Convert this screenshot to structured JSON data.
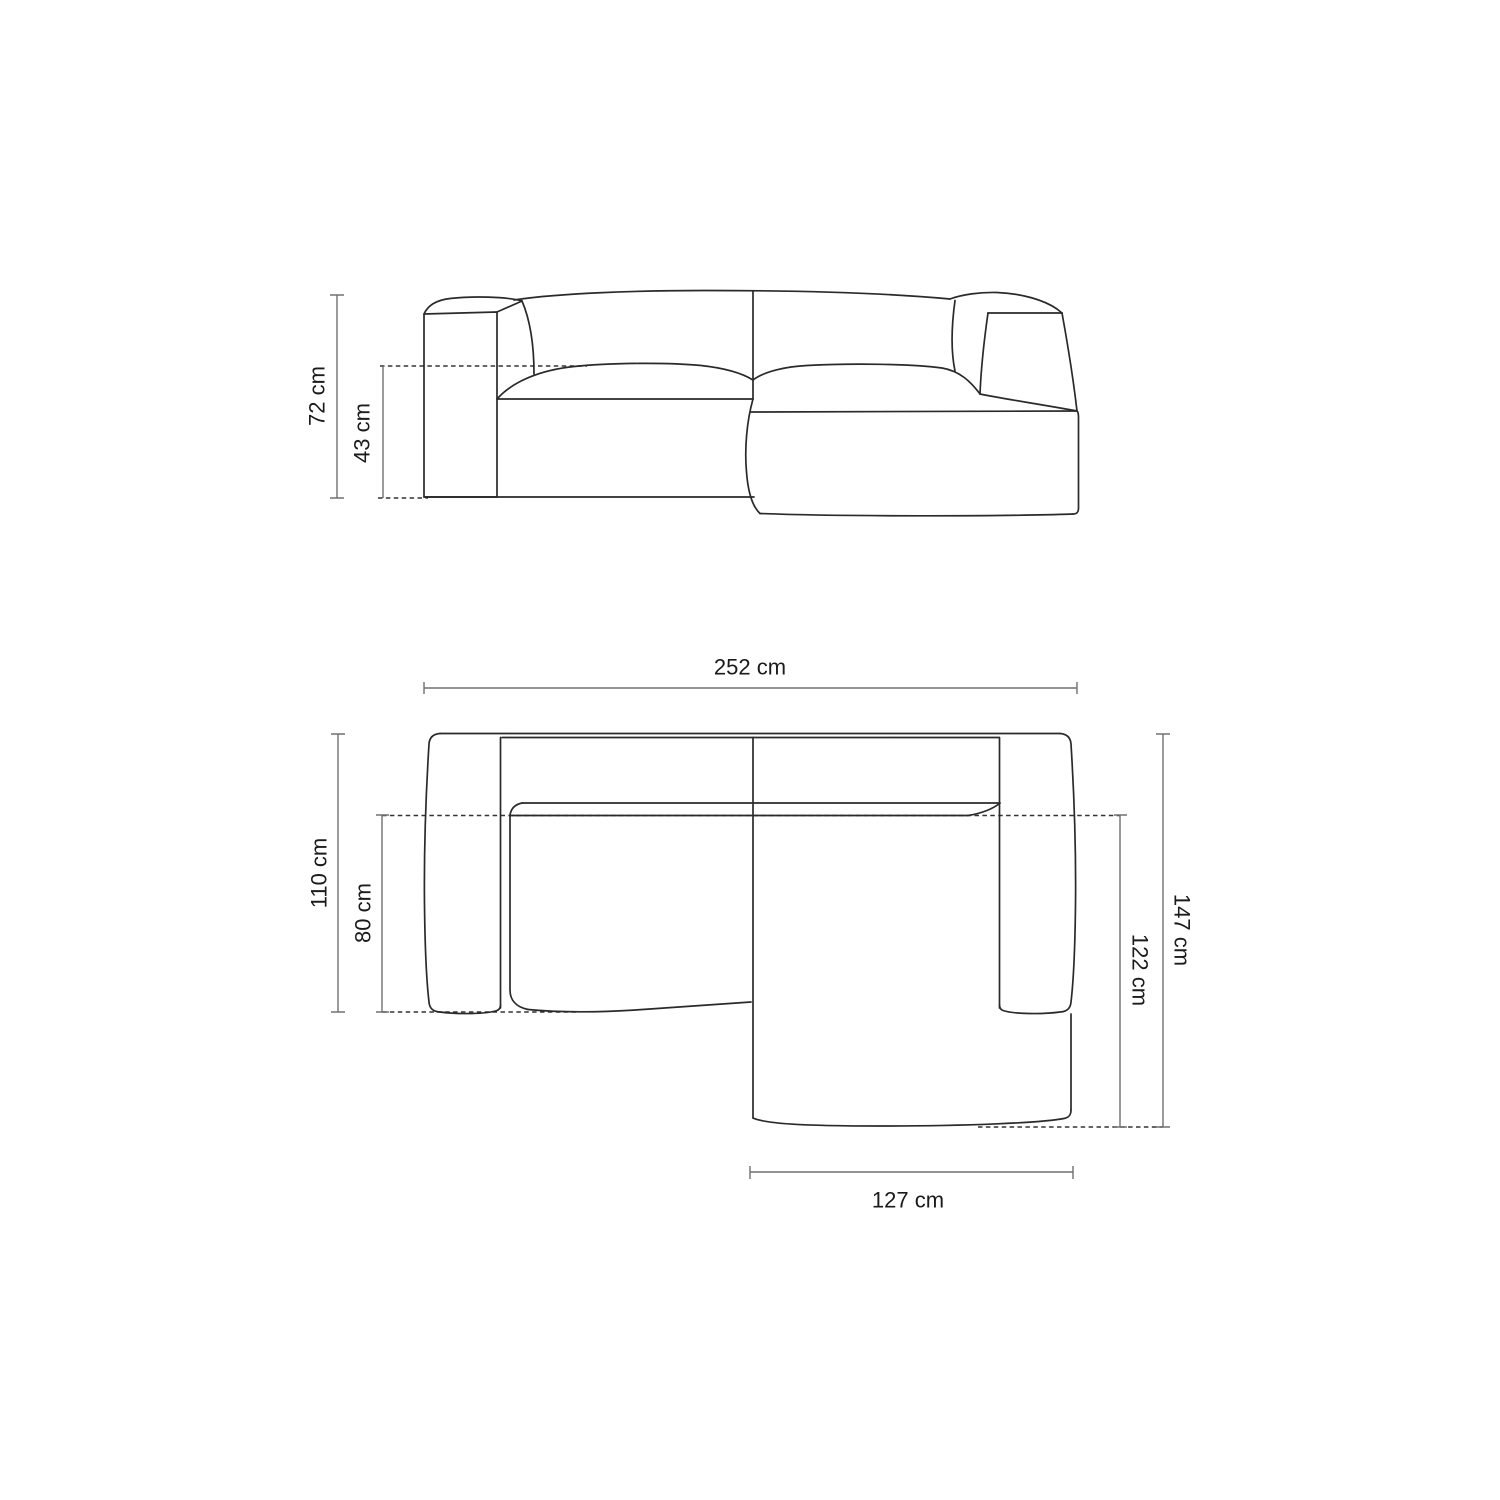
{
  "diagram": {
    "subject": "corner-sofa-with-chaise-dimension-drawing",
    "background": "#ffffff",
    "colors": {
      "outline": "#2a2a2a",
      "dimension_line": "#707070",
      "dashed_line": "#333333",
      "label_text": "#1b1b1b"
    },
    "front_view": {
      "total_height": "72 cm",
      "seat_height": "43 cm"
    },
    "top_view": {
      "total_width": "252 cm",
      "sofa_depth": "110 cm",
      "seat_depth": "80 cm",
      "total_depth": "147 cm",
      "chaise_depth": "122 cm",
      "chaise_width": "127 cm"
    }
  }
}
